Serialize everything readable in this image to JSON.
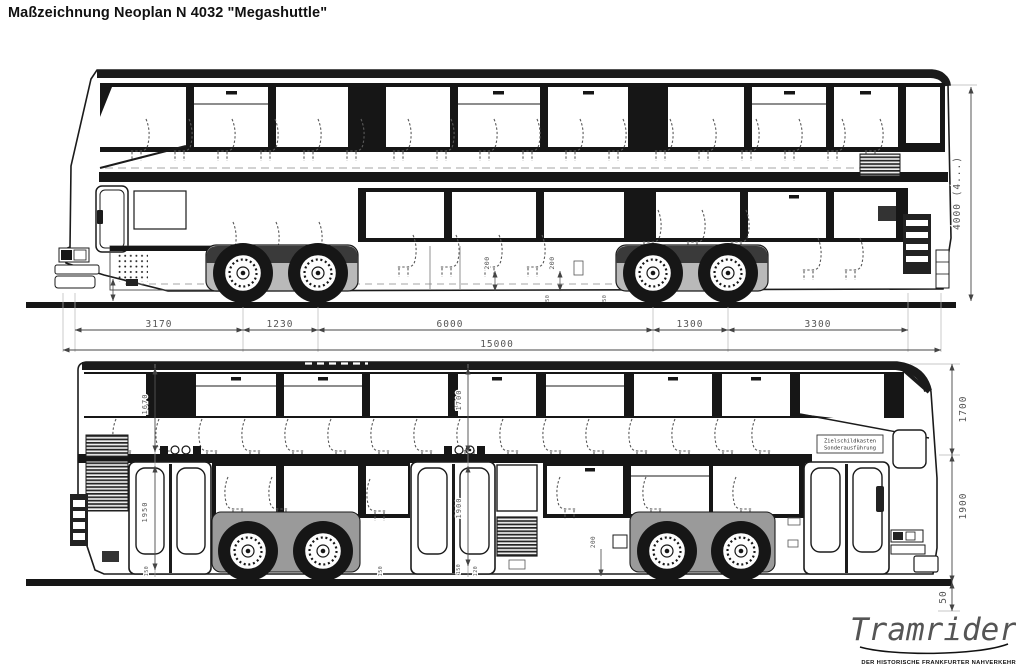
{
  "title": "Maßzeichnung Neoplan N 4032 \"Megashuttle\"",
  "upper_view": {
    "axle_dims": [
      "3170",
      "1230",
      "6000",
      "1300",
      "3300"
    ],
    "total_length": "15000",
    "overall_height": "4000    (4...)",
    "floor_dims": [
      "200",
      "200"
    ],
    "clearance_dims": [
      "150",
      "450"
    ]
  },
  "lower_view": {
    "rear_chain": {
      "upper": "1670",
      "door": "1950",
      "step": "150"
    },
    "mid_chain": {
      "upper": "1700",
      "door": "1900",
      "steps": [
        "150",
        "120"
      ]
    },
    "extra_dims": {
      "skirt": "150",
      "wheelbox": "200"
    },
    "sign_line1": "Zielschildkasten",
    "sign_line2": "Sonderausführung",
    "right_chain": {
      "upper_deck": "1700",
      "lower_deck": "1900",
      "below_floor": "50"
    }
  },
  "logo": {
    "name": "Tramrider",
    "caption": "DER HISTORISCHE FRANKFURTER NAHVERKEHR"
  },
  "colors": {
    "ink": "#1b1b1b",
    "dim_text": "#555555",
    "paper": "#ffffff"
  }
}
